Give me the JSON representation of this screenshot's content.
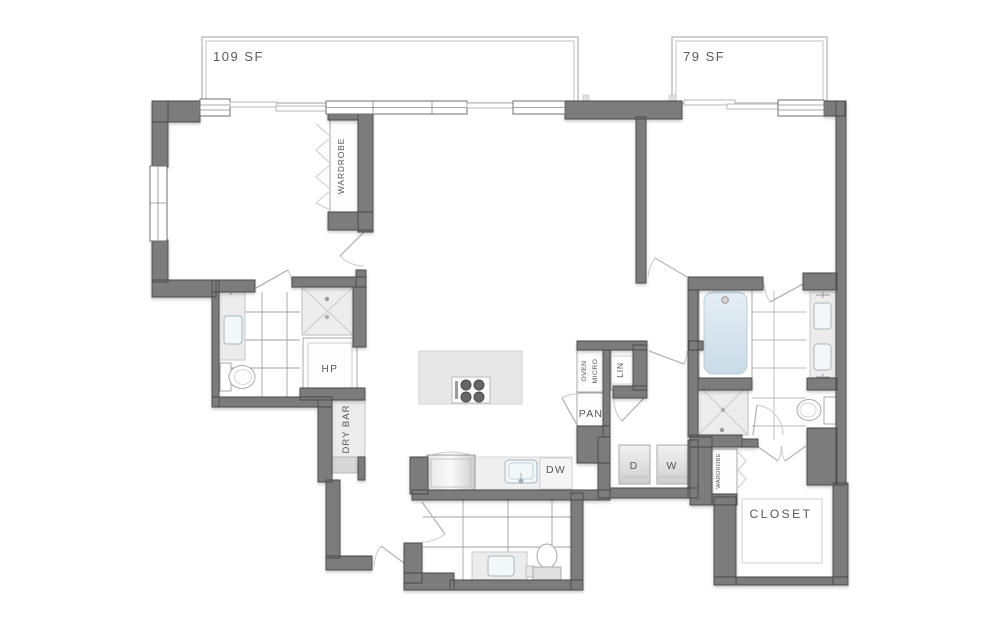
{
  "labels": {
    "balcony_left": "109 SF",
    "balcony_right": "79 SF",
    "wardrobe_main": "WARDROBE",
    "heat_pump": "HP",
    "dry_bar": "DRY BAR",
    "oven": "OVEN",
    "micro": "MICRO",
    "pantry": "PAN",
    "linen": "LIN",
    "dishwasher": "DW",
    "dryer": "D",
    "washer": "W",
    "wardrobe_small": "WARDROBE",
    "closet": "CLOSET"
  },
  "colors": {
    "wall": "#7c7c7c",
    "wall_outline": "#4a4a4a",
    "fixture_light": "#ececec",
    "tub_fill": "#d9e5ee",
    "label_text": "#565656",
    "door_arc": "#cccccc",
    "balcony_outline": "#c3c3c3"
  }
}
